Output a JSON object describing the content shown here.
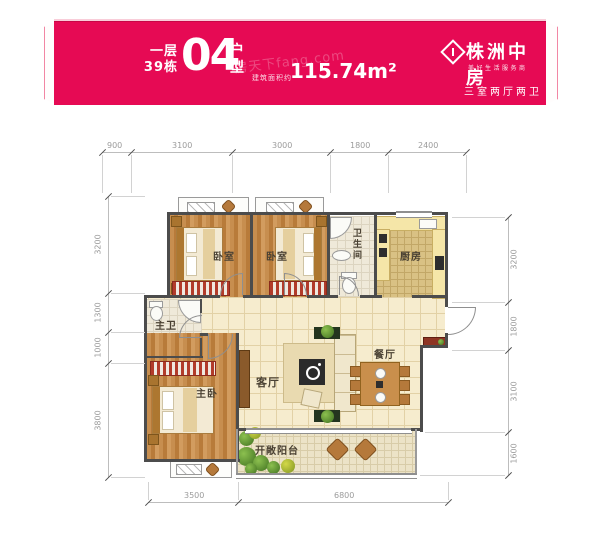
{
  "header": {
    "floor_label": "一层",
    "building_label": "39栋",
    "unit_number": "04",
    "unit_char1": "户",
    "unit_char2": "型",
    "area_label": "建筑面积约",
    "area_value": "115.74m²",
    "watermark": "房天下fang.com",
    "brand": {
      "name": "株洲中房",
      "slogan": "美好生活服务商",
      "tagline": "三室两厅两卫",
      "logo_icon": "diamond-logo"
    }
  },
  "plan": {
    "rooms": [
      {
        "id": "bedroom-1",
        "label": "卧室"
      },
      {
        "id": "bedroom-2",
        "label": "卧室"
      },
      {
        "id": "bathroom",
        "label": "卫生间"
      },
      {
        "id": "kitchen",
        "label": "厨房"
      },
      {
        "id": "master-bath",
        "label": "主卫"
      },
      {
        "id": "master-bedroom",
        "label": "主卧"
      },
      {
        "id": "living-room",
        "label": "客厅"
      },
      {
        "id": "dining-room",
        "label": "餐厅"
      },
      {
        "id": "balcony",
        "label": "开敞阳台"
      }
    ],
    "dimensions": {
      "top": [
        "900",
        "3100",
        "3000",
        "1800",
        "2400"
      ],
      "left": [
        "3200",
        "1300",
        "1000",
        "3800"
      ],
      "right": [
        "3200",
        "1800",
        "3100",
        "1600"
      ],
      "bottom": [
        "3500",
        "6800"
      ]
    }
  },
  "colors": {
    "banner": "#e60a54",
    "wall": "#4c4c4c",
    "wood_floor": "#c08a4e",
    "tile_floor": "#f6ecce",
    "wardrobe_red": "#b23b2a"
  }
}
